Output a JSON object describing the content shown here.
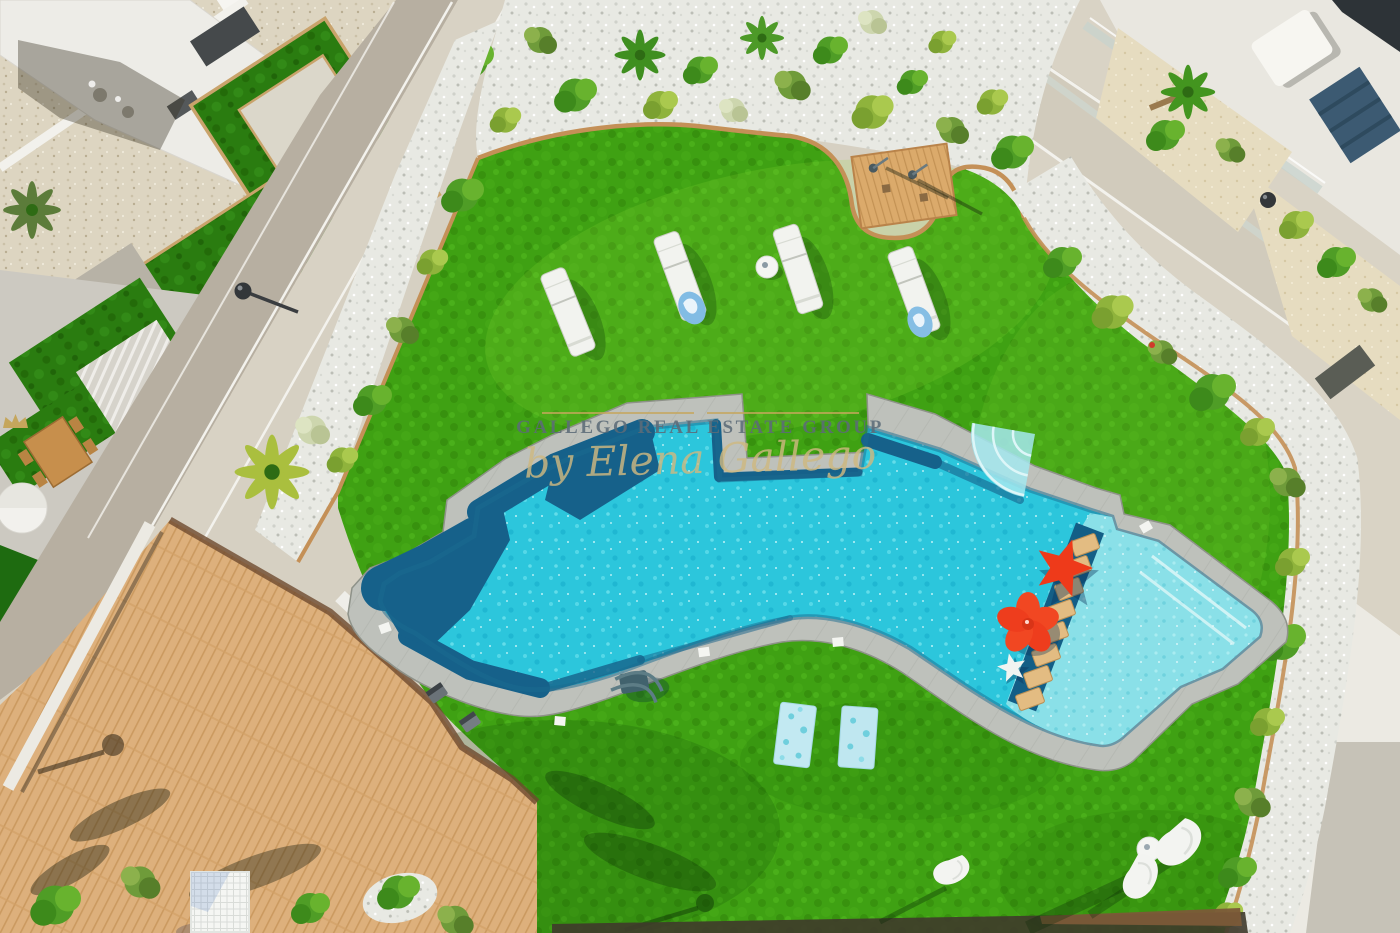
{
  "watermark": {
    "brand": "GALLEGO REAL ESTATE GROUP",
    "byline": "by Elena Gallego",
    "brand_color": "#5c6b78",
    "gold_color": "#c5a65c",
    "crown_icon": "crown"
  },
  "scene": {
    "setting": "aerial-view-residential-pool-garden",
    "palette": {
      "grass": "#3fa113",
      "private_lawn": "#2a7c10",
      "pool_water": "#2cc6dc",
      "pool_shallow": "#8ae0e8",
      "pool_deep_band": "#16618a",
      "coping": "#bec1bb",
      "deck_wood": "#ddb07c",
      "pebbles": "#e8e9e3",
      "gravel": "#ddd5c1",
      "path": "#d6d0c2",
      "float_red": "#ee3a1a",
      "towel_blue": "#bfe7f0"
    }
  }
}
